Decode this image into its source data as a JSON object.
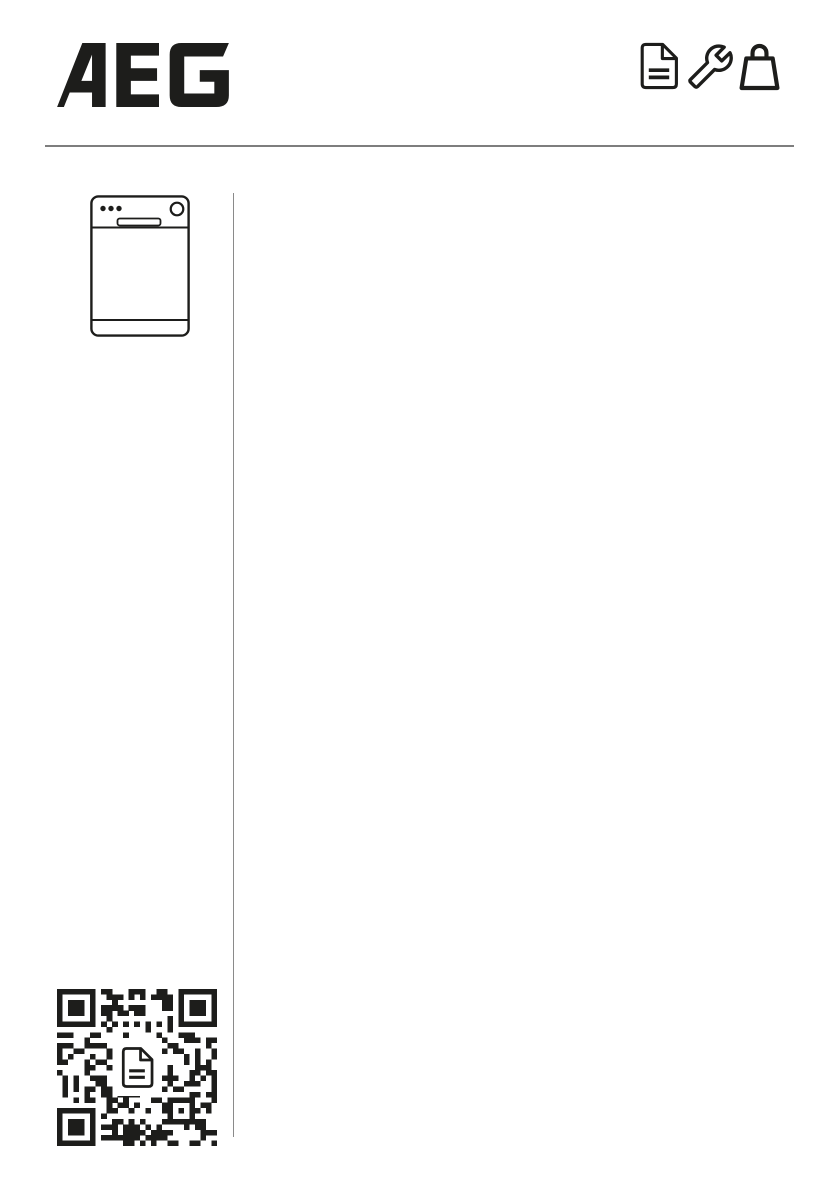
{
  "header": {
    "brand": "AEG",
    "icons": [
      {
        "name": "document-icon"
      },
      {
        "name": "wrench-icon"
      },
      {
        "name": "shopping-bag-icon"
      }
    ]
  },
  "left_column": {
    "product_illustration": "dishwasher",
    "qr": {
      "name": "qr-code",
      "modules": 29,
      "center_icon": "document-icon",
      "seed": 7,
      "fill_ratio": 0.47
    }
  },
  "colors": {
    "ink": "#1d1d1b",
    "rule": "#7e7e7e",
    "divider": "#8a8a8a",
    "background": "#ffffff"
  }
}
